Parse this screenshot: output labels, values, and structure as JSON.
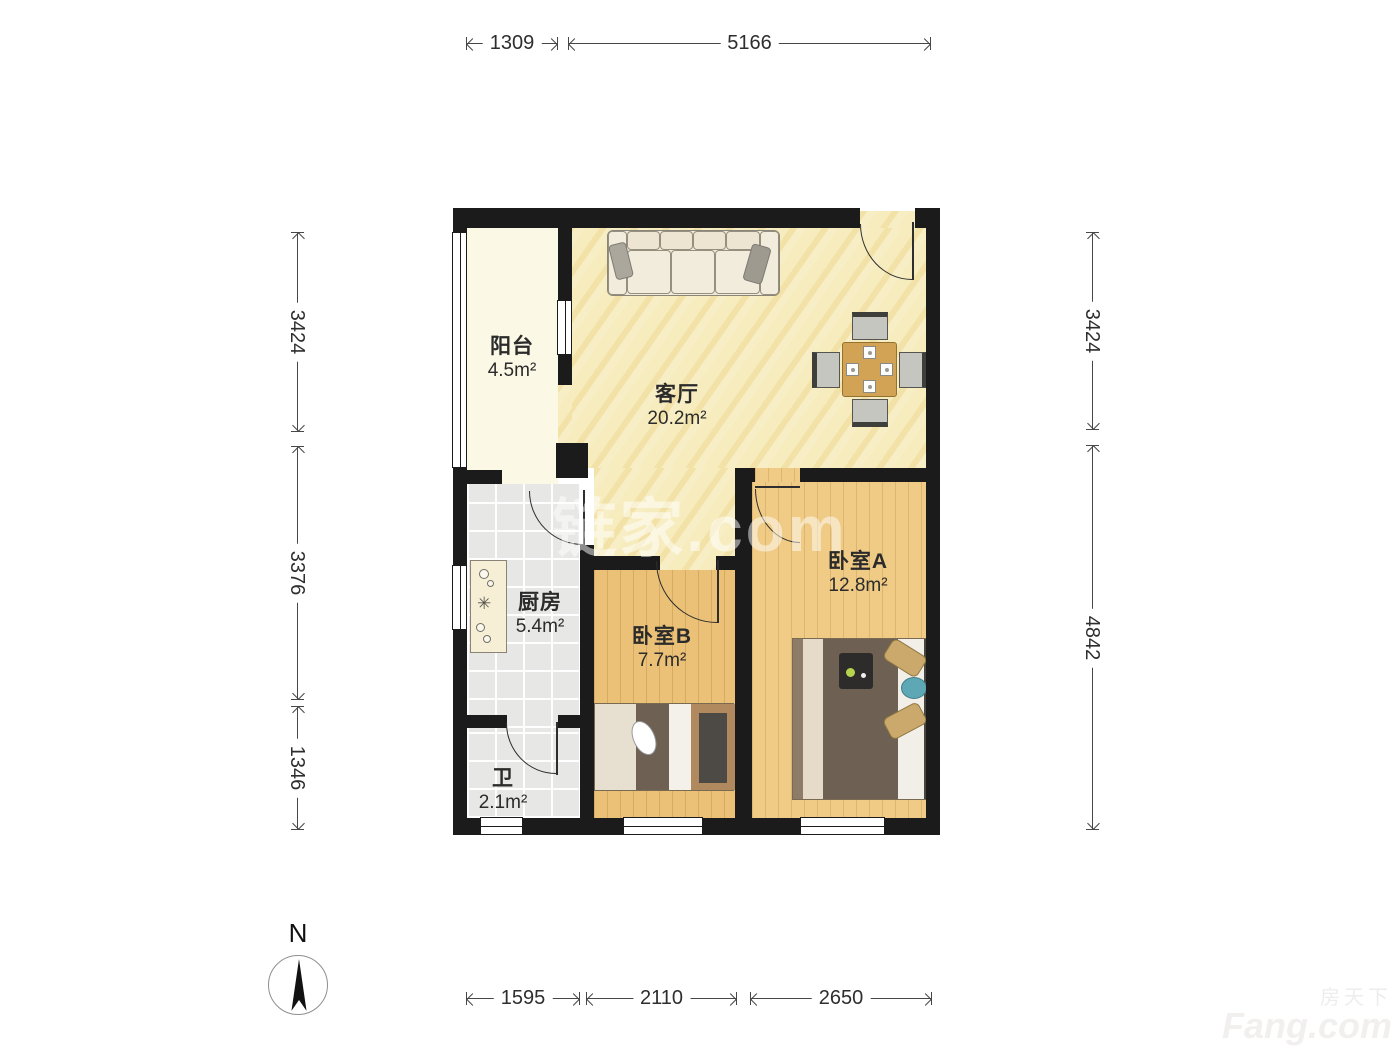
{
  "rooms": [
    {
      "name": "阳台",
      "area": "4.5m²"
    },
    {
      "name": "客厅",
      "area": "20.2m²"
    },
    {
      "name": "厨房",
      "area": "5.4m²"
    },
    {
      "name": "卫",
      "area": "2.1m²"
    },
    {
      "name": "卧室B",
      "area": "7.7m²"
    },
    {
      "name": "卧室A",
      "area": "12.8m²"
    }
  ],
  "dimensions": {
    "top": [
      "1309",
      "5166"
    ],
    "bottom": [
      "1595",
      "2110",
      "2650"
    ],
    "left": [
      "3424",
      "3376",
      "1346"
    ],
    "right": [
      "3424",
      "4842"
    ]
  },
  "compass": {
    "north_label": "N"
  },
  "watermarks": {
    "center": "链家.com",
    "bottom_right_cn": "房天下",
    "bottom_right_en": "Fang.com"
  },
  "colors": {
    "wall": "#1b1b1b",
    "living_floor": "#F7EDC2",
    "bedroom_floor": "#EFCB85",
    "tile_floor": "#E7E7E5",
    "balcony_floor": "#FBF8E5",
    "dimension_line": "#474747"
  }
}
